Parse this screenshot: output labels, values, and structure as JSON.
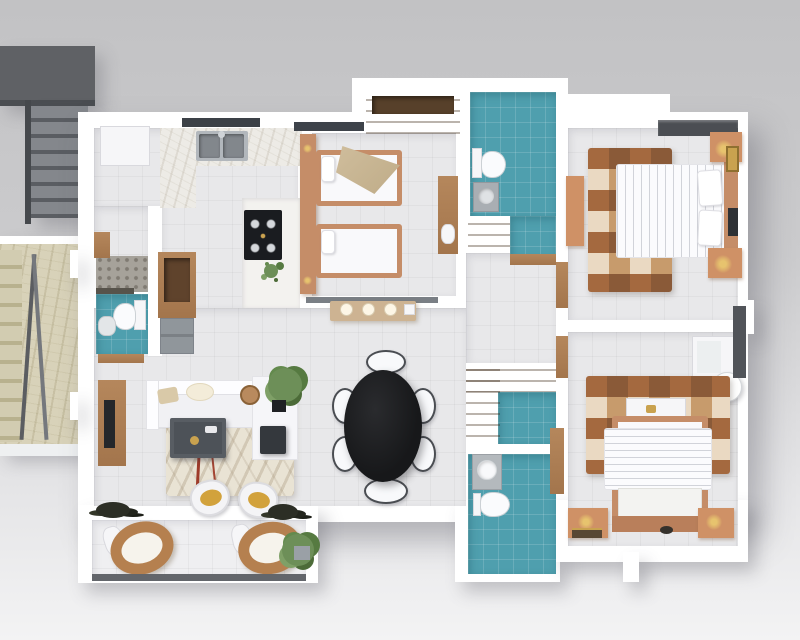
{
  "scene": {
    "label": "3D apartment floor plan, top-down architectural render",
    "width_px": 800,
    "height_px": 640
  },
  "palette": {
    "wall": "#ffffff",
    "floor_tile": "#e8e8ea",
    "teal_tile": "#4f9fae",
    "wood": "#b5875c",
    "wood_dark": "#5f432c",
    "salmon": "#c58d68",
    "dark_fixture": "#24272b",
    "gray_metal": "#90969b",
    "stair_gray": "#5f6165",
    "marble_beige": "#d8d2b9",
    "rug_brown_1": "#8a5a38",
    "rug_brown_2": "#c79b6c",
    "rug_brown_3": "#ead9c2",
    "rug_brown_4": "#a4693f",
    "lamp_gold": "#e7c36e",
    "cushion_mustard": "#d2a23c",
    "plant_green": "#6d8f58",
    "table_black": "#17181a",
    "background_gray": "#c8c8ca"
  },
  "rooms": {
    "kitchen": {
      "label": "Kitchen"
    },
    "kids_bedroom": {
      "label": "Kids Bedroom (twin beds)"
    },
    "master_bedroom": {
      "label": "Master Bedroom"
    },
    "second_bedroom": {
      "label": "Second Bedroom"
    },
    "family_bathroom": {
      "label": "Family Bathroom"
    },
    "ensuite_bathroom": {
      "label": "Second Bathroom"
    },
    "guest_toilet": {
      "label": "Guest Toilet"
    },
    "walk_in_closet": {
      "label": "Walk-in Closet"
    },
    "living_room": {
      "label": "Living Room"
    },
    "dining_area": {
      "label": "Dining Area"
    },
    "hallway": {
      "label": "Hallway"
    },
    "balcony": {
      "label": "Balcony"
    },
    "stairwell": {
      "label": "Exterior Stairwell"
    },
    "landing": {
      "label": "Marble Landing"
    }
  },
  "furniture": {
    "fridge": "Refrigerator",
    "kitchen_sink": "Double Kitchen Sink",
    "stove": "Gas Stove",
    "twin_bed_1": "Twin Bed 1",
    "twin_bed_2": "Twin Bed 2",
    "wardrobe": "Wardrobe",
    "master_bed": "Double Bed",
    "second_bed": "Double Bed",
    "dining_table": "Oval Dining Table (6 chairs)",
    "sofa": "L-shaped Sofa",
    "coffee_table": "Coffee Table",
    "tv_console": "TV Console",
    "accent_chairs": "Accent Chairs",
    "lounge_chairs": "Balcony Lounge Chairs",
    "toilet": "Toilet",
    "vanity": "Vanity Sink"
  }
}
